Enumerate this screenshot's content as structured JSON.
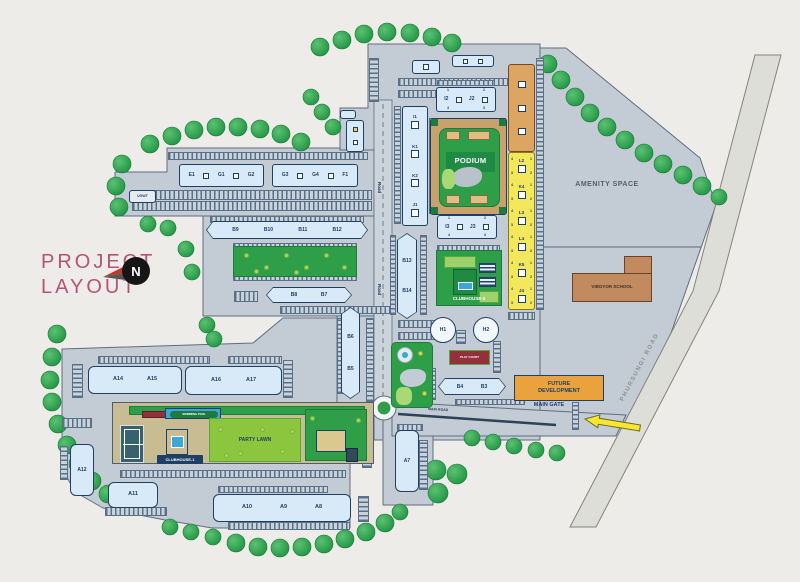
{
  "title": {
    "line1": "PROJECT",
    "line2": "LAYOUT"
  },
  "compass": {
    "n": "N"
  },
  "roads": {
    "road1": "Road",
    "road2": "Road",
    "main_road": "MAIN ROAD",
    "phursungi": "PHURSUNGI ROAD",
    "main_gate": "MAIN GATE"
  },
  "areas": {
    "amenity": "AMENITY SPACE",
    "school": "VIBGYOR SCHOOL",
    "podium": "PODIUM",
    "party_lawn": "PARTY LAWN",
    "play_court": "PLAY COURT",
    "future_development": "FUTURE DEVELOPMENT",
    "clubhouse1": "CLUBHOUSE-1",
    "clubhouse2": "CLUBHOUSE-2",
    "swimming_pool": "SWIMMING POOL",
    "ugwt": "UGWT"
  },
  "towers": {
    "e1": "E1",
    "g1": "G1",
    "g2": "G2",
    "g3": "G3",
    "g4": "G4",
    "f1": "F1",
    "b9": "B9",
    "b10": "B10",
    "b11": "B11",
    "b12": "B12",
    "b8": "B8",
    "b7": "B7",
    "b6": "B6",
    "b5": "B5",
    "b13": "B13",
    "b14": "B14",
    "b4": "B4",
    "b3": "B3",
    "i1": "I1",
    "k1": "K1",
    "k2": "K2",
    "j1": "J1",
    "i2": "I2",
    "j2": "J2",
    "i3": "I3",
    "j3": "J3",
    "l2": "L2",
    "k4": "K4",
    "l3": "L3",
    "l4": "L4",
    "k5": "K5",
    "j4": "J4",
    "h1": "H1",
    "h2": "H2",
    "a14": "A14",
    "a15": "A15",
    "a16": "A16",
    "a17": "A17",
    "a12": "A12",
    "a11": "A11",
    "a10": "A10",
    "a9": "A9",
    "a8": "A8",
    "a7": "A7"
  },
  "digits": {
    "d1": "1",
    "d2": "2",
    "d3": "3",
    "d4": "4"
  },
  "colors": {
    "land": "#C3CBD4",
    "land_stroke": "#5E6E7F",
    "road": "#CCD4DB",
    "building": "#D8EAF7",
    "navy": "#1E3F66",
    "lawn": "#2E9F48",
    "lawn_light": "#A8D974",
    "party": "#8CC63F",
    "yellow": "#F3E75B",
    "orange": "#DCA562",
    "school": "#C18A5F",
    "future": "#EAA33C",
    "court": "#93303C",
    "title": "#B5537B",
    "arrow": "#F7E733",
    "pool": "#3BA6D8",
    "tan": "#C9A26B"
  }
}
